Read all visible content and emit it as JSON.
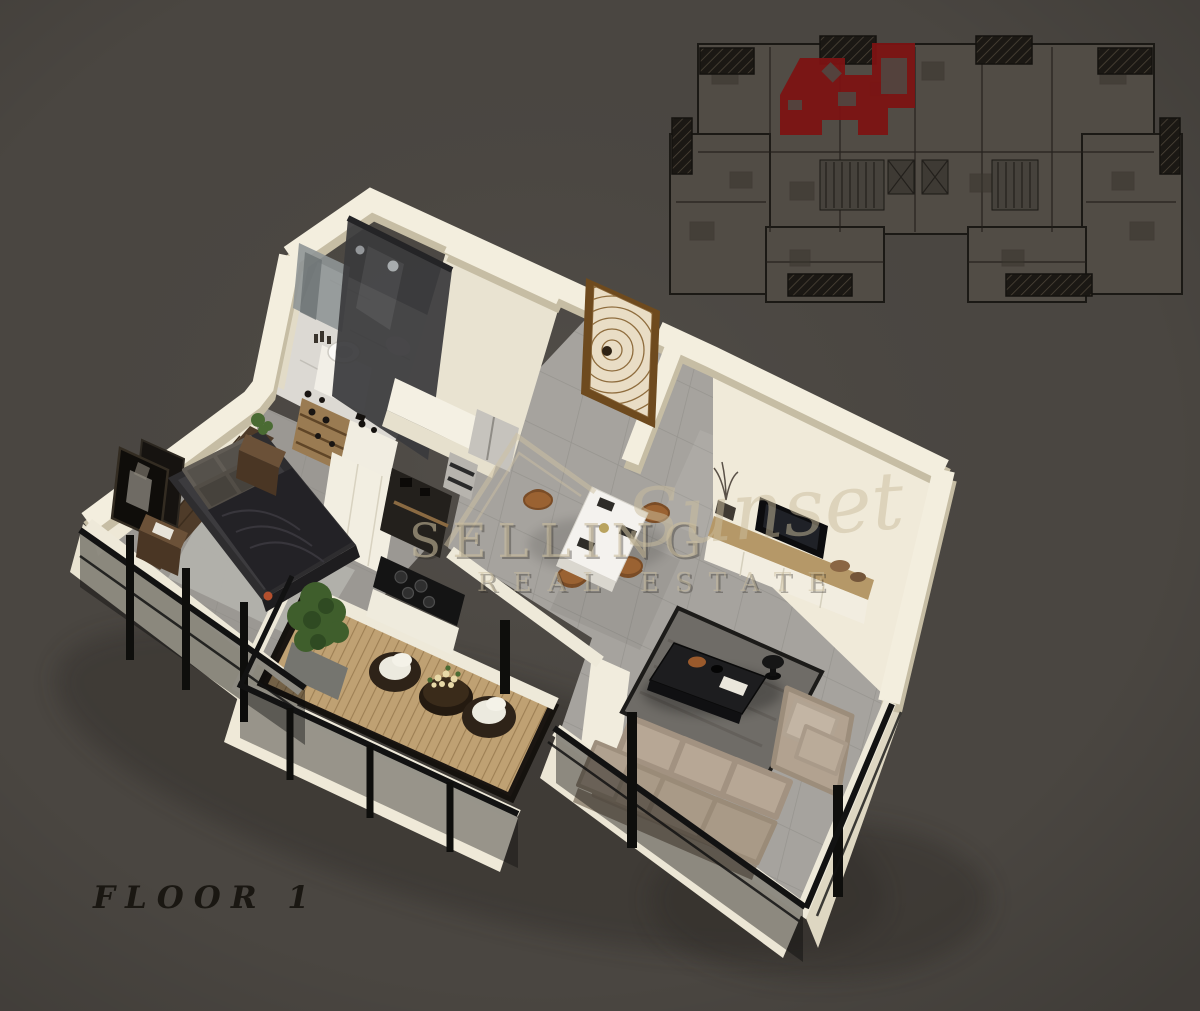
{
  "page": {
    "width": "1200",
    "height": "1011",
    "background": "#4a4641"
  },
  "floor_label": "FLOOR 1",
  "watermark": {
    "word_main": "SELLING",
    "word_script": "Sunset",
    "word_sub": "REAL ESTATE",
    "logo_icon": "house-roof-icon",
    "color": "#cbbe9e"
  },
  "site_plan": {
    "highlighted_unit_color": "#7c1313",
    "building_color": "#514c45",
    "line_color": "#1b1915"
  },
  "palette": {
    "wall_cream": "#f3eede",
    "wall_shadow": "#c6bda4",
    "floor_tile": "#a6a39e",
    "bathroom_marble": "#dcd9d3",
    "deck_wood": "#bfa173",
    "sofa_beige": "#b2a290",
    "bed_dark": "#2e2d2f",
    "door_wood": "#6e4a1e",
    "railing_black": "#121212"
  }
}
